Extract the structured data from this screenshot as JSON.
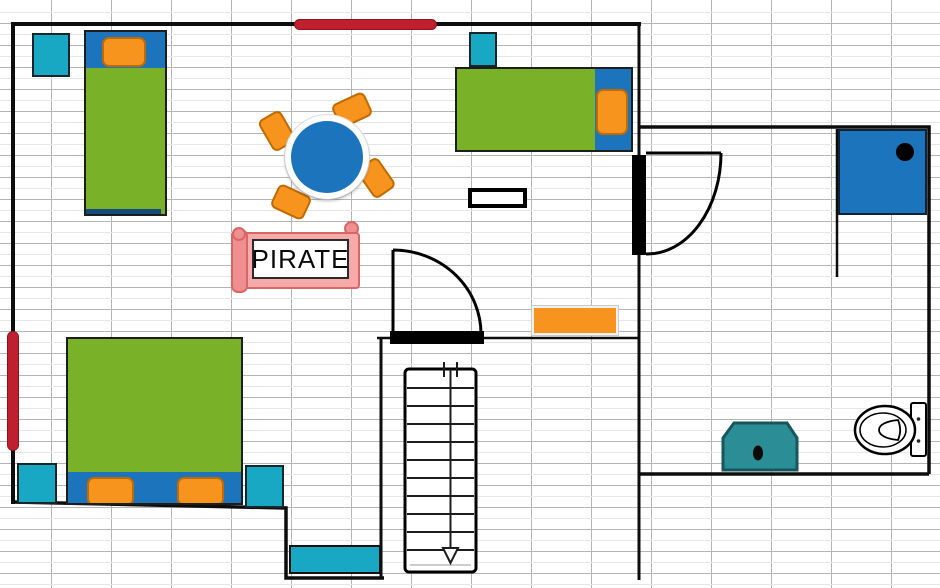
{
  "labels": {
    "pirate_sign": "PIRATE"
  },
  "colors": {
    "green": "#79b229",
    "blue": "#1b74bc",
    "cyan": "#18a8c4",
    "orange": "#f7941d",
    "orange-dark": "#c06a00",
    "red": "#c0202e",
    "red-dark": "#8c1420",
    "teal": "#2b8e96",
    "teal-dark": "#17565c",
    "pink": "#f6aaaa",
    "pink-mid": "#ef8f8f",
    "pink-dark": "#d96666",
    "wall": "#0d0d0d",
    "grid": "#b5b5b5",
    "grid-faint": "#e6e6e6"
  },
  "stairs": {
    "treads": 10,
    "arrow_direction": "down"
  },
  "objects": [
    {
      "name": "single-bed-left",
      "parts": [
        "blue-headboard",
        "orange-pillow",
        "green-mattress"
      ]
    },
    {
      "name": "single-bed-right",
      "parts": [
        "blue-headboard",
        "orange-pillow",
        "green-mattress"
      ]
    },
    {
      "name": "double-bed",
      "parts": [
        "green-mattress",
        "blue-footboard",
        "orange-pillow",
        "orange-pillow"
      ]
    },
    {
      "name": "round-table",
      "chairs": 4
    },
    {
      "name": "pirate-sign",
      "text": "PIRATE"
    },
    {
      "name": "nightstand",
      "count": 4
    },
    {
      "name": "window",
      "count": 2
    },
    {
      "name": "door",
      "count": 2
    },
    {
      "name": "picture-frame",
      "count": 1
    },
    {
      "name": "rug",
      "count": 1
    },
    {
      "name": "shower",
      "count": 1
    },
    {
      "name": "toilet",
      "count": 1
    },
    {
      "name": "sink",
      "count": 1
    },
    {
      "name": "doormat",
      "count": 1
    },
    {
      "name": "staircase",
      "count": 1
    }
  ]
}
